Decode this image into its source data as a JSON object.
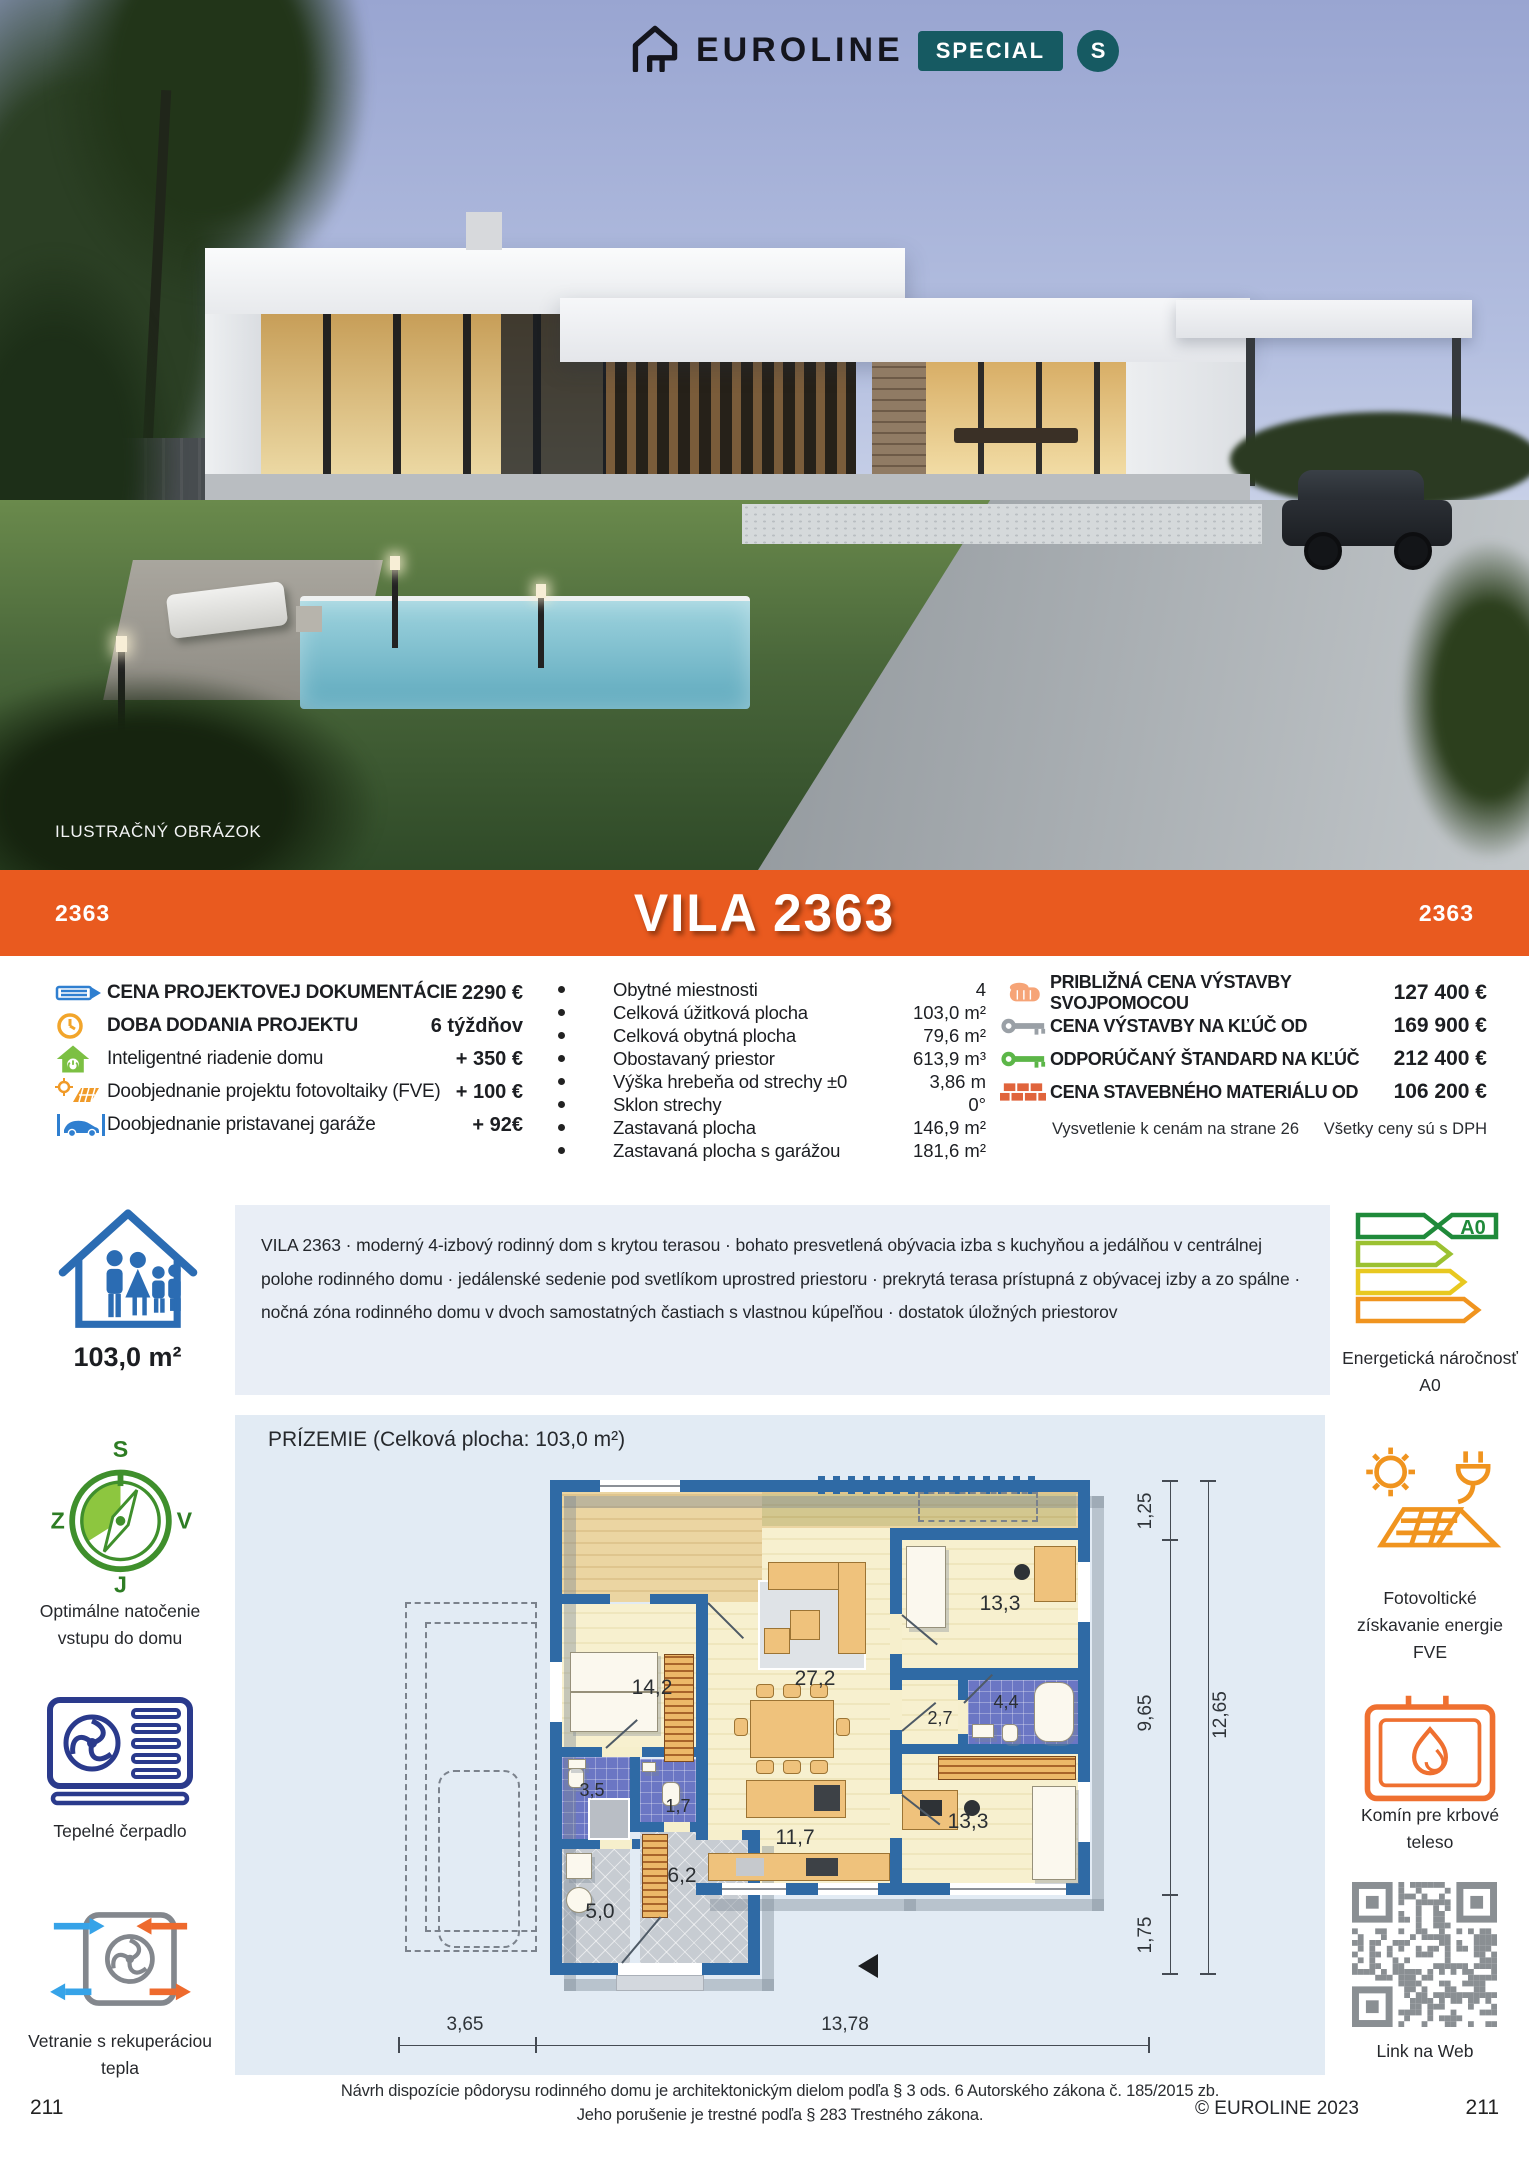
{
  "header": {
    "brand": "EUROLINE",
    "badge": "SPECIAL",
    "badge_circle": "S"
  },
  "photo": {
    "caption": "ILUSTRAČNÝ OBRÁZOK"
  },
  "title_band": {
    "code_left": "2363",
    "title": "VILA 2363",
    "code_right": "2363"
  },
  "options": {
    "items": [
      {
        "icon": "pencil-icon",
        "label": "CENA PROJEKTOVEJ DOKUMENTÁCIE",
        "value": "2290 €"
      },
      {
        "icon": "clock-icon",
        "label": "DOBA DODANIA PROJEKTU",
        "value": "6 týždňov"
      },
      {
        "icon": "smart-home-icon",
        "label": "Inteligentné riadenie domu",
        "value": "+ 350 €"
      },
      {
        "icon": "solar-icon",
        "label": "Doobjednanie projektu fotovoltaiky (FVE)",
        "value": "+ 100 €"
      },
      {
        "icon": "car-icon",
        "label": "Doobjednanie pristavanej garáže",
        "value": "+ 92€"
      }
    ]
  },
  "specs": {
    "items": [
      {
        "label": "Obytné miestnosti",
        "value": "4"
      },
      {
        "label": "Celková úžitková plocha",
        "value": "103,0 m²"
      },
      {
        "label": "Celková obytná plocha",
        "value": "79,6 m²"
      },
      {
        "label": "Obostavaný priestor",
        "value": "613,9 m³"
      },
      {
        "label": "Výška hrebeňa od strechy ±0",
        "value": "3,86 m"
      },
      {
        "label": "Sklon strechy",
        "value": "0°"
      },
      {
        "label": "Zastavaná plocha",
        "value": "146,9 m²"
      },
      {
        "label": "Zastavaná plocha s garážou",
        "value": "181,6 m²"
      }
    ]
  },
  "prices": {
    "items": [
      {
        "icon": "hand-icon",
        "label": "PRIBLIŽNÁ CENA VÝSTAVBY SVOJPOMOCOU",
        "value": "127 400 €"
      },
      {
        "icon": "key-gray-icon",
        "label": "CENA VÝSTAVBY NA KĽÚČ OD",
        "value": "169 900 €"
      },
      {
        "icon": "key-green-icon",
        "label": "ODPORÚČANÝ ŠTANDARD NA KĽÚČ",
        "value": "212 400 €"
      },
      {
        "icon": "bricks-icon",
        "label": "CENA STAVEBNÉHO MATERIÁLU OD",
        "value": "106 200 €"
      }
    ],
    "note_left": "Vysvetlenie k cenám na strane 26",
    "note_right": "Všetky ceny sú s DPH"
  },
  "description": {
    "area": "103,0 m²",
    "text": "VILA 2363 · moderný 4-izbový rodinný dom s krytou terasou · bohato presvetlená obývacia izba s kuchyňou a jedálňou v centrálnej polohe rodinného domu · jedálenské sedenie pod svetlíkom uprostred priestoru · prekrytá terasa prístupná z obývacej izby a zo spálne · nočná zóna rodinného domu v dvoch samostatných častiach s vlastnou kúpeľňou · dostatok úložných priestorov"
  },
  "badges_left": {
    "compass": {
      "n": "S",
      "e": "V",
      "s": "J",
      "w": "Z",
      "label": "Optimálne natočenie vstupu do domu"
    },
    "heatpump": {
      "label": "Tepelné čerpadlo"
    },
    "ventilation": {
      "label": "Vetranie s rekuperáciou tepla"
    }
  },
  "badges_right": {
    "energy": {
      "value": "A0",
      "label": "Energetická náročnosť A0"
    },
    "fve": {
      "label": "Fotovoltické získavanie energie FVE"
    },
    "fireplace": {
      "label": "Komín pre krbové teleso"
    },
    "qr": {
      "label": "Link na Web"
    }
  },
  "plan": {
    "title": "PRÍZEMIE (Celková plocha: 103,0 m²)",
    "rooms": [
      {
        "name": "bedroom-left",
        "area": "14,2"
      },
      {
        "name": "living-dining",
        "area": "27,2"
      },
      {
        "name": "bedroom-top-right",
        "area": "13,3"
      },
      {
        "name": "hall-small",
        "area": "2,7"
      },
      {
        "name": "bathroom",
        "area": "4,4"
      },
      {
        "name": "bathroom-small",
        "area": "3,5"
      },
      {
        "name": "wc",
        "area": "1,7"
      },
      {
        "name": "kitchen",
        "area": "11,7"
      },
      {
        "name": "bedroom-bottom-right",
        "area": "13,3"
      },
      {
        "name": "hallway",
        "area": "6,2"
      },
      {
        "name": "utility",
        "area": "5,0"
      }
    ],
    "dims": {
      "d125": "1,25",
      "d965": "9,65",
      "d1265": "12,65",
      "d175": "1,75",
      "d365": "3,65",
      "d1378": "13,78"
    }
  },
  "footer": {
    "legal1": "Návrh dispozície pôdorysu rodinného domu je architektonickým dielom podľa § 3 ods. 6 Autorského zákona č. 185/2015 zb.",
    "legal2": "Jeho porušenie je trestné podľa § 283 Trestného zákona.",
    "copyright": "© EUROLINE 2023",
    "page_left": "211",
    "page_right": "211"
  }
}
